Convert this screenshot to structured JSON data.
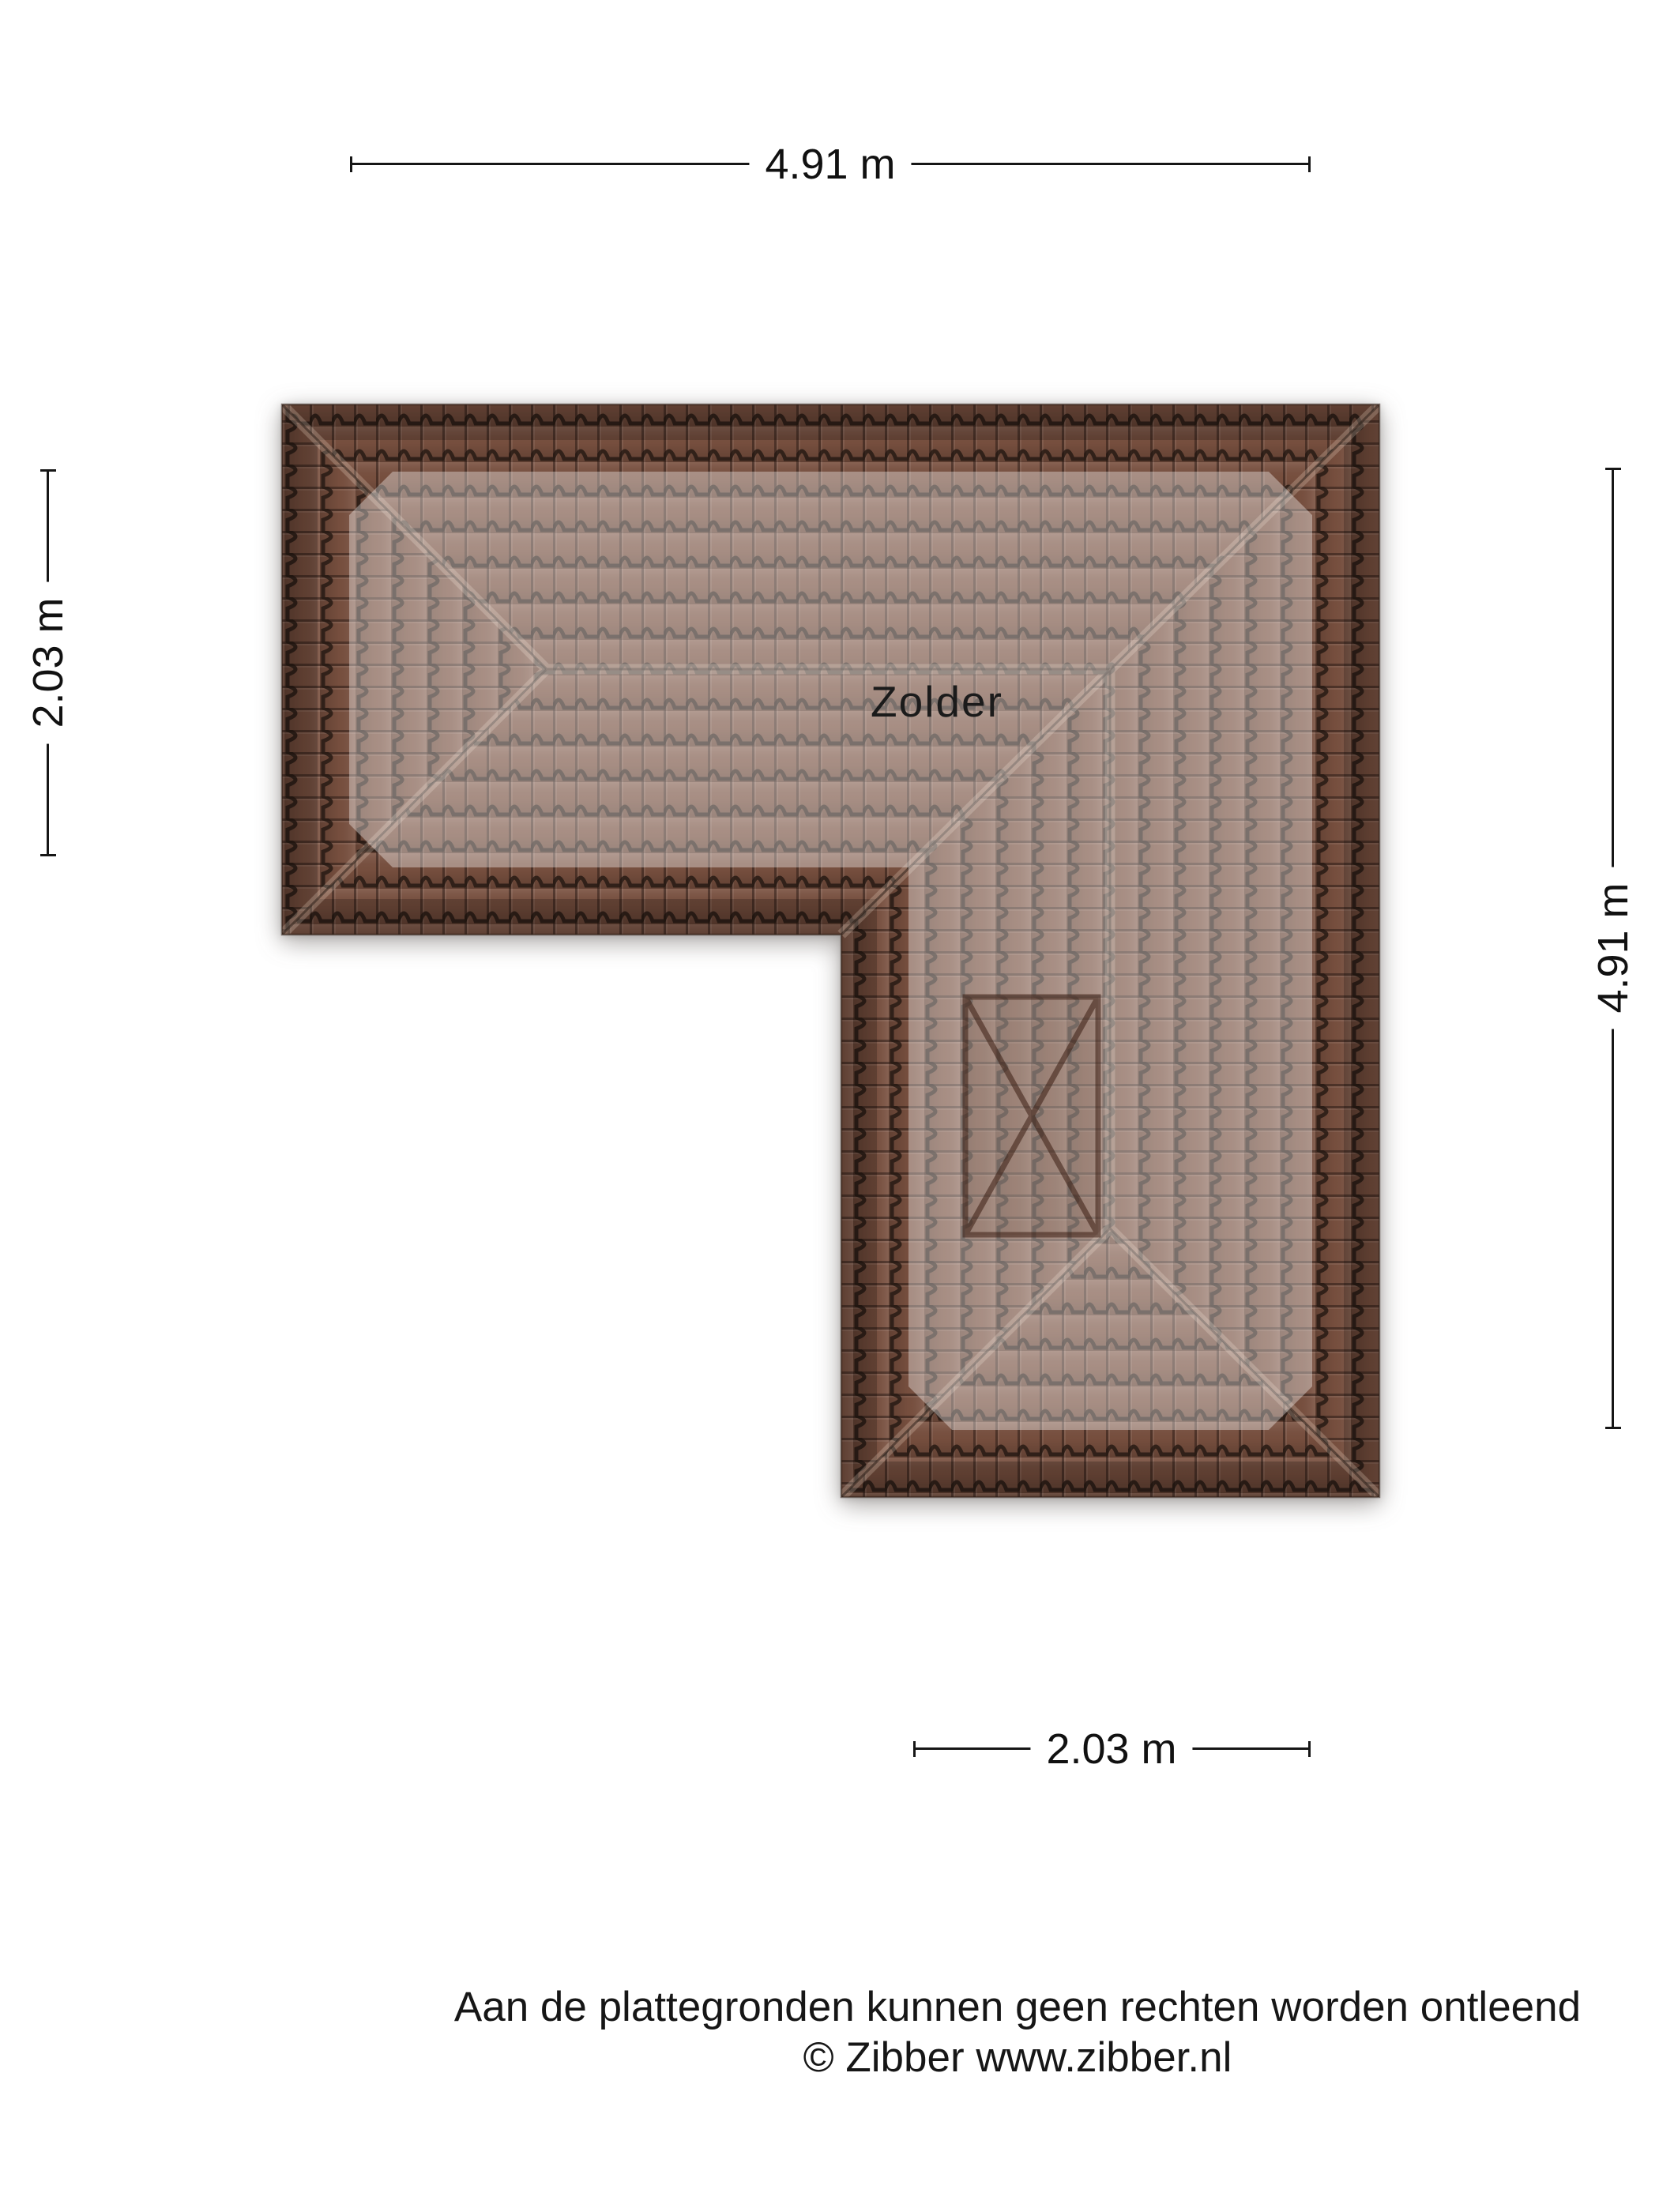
{
  "room_label": "Zolder",
  "dimensions": {
    "top": "4.91 m",
    "left": "2.03 m",
    "right": "4.91 m",
    "bottom": "2.03 m"
  },
  "footer": {
    "line1": "Aan de plattegronden kunnen geen rechten worden ontleend",
    "line2": "© Zibber www.zibber.nl"
  },
  "colors": {
    "tile_base": "#7a5140",
    "tile_line": "#241812",
    "overlay": "#ffffff",
    "dim_color": "#161616",
    "window_marker": "#3a1e12",
    "background": "#ffffff"
  }
}
